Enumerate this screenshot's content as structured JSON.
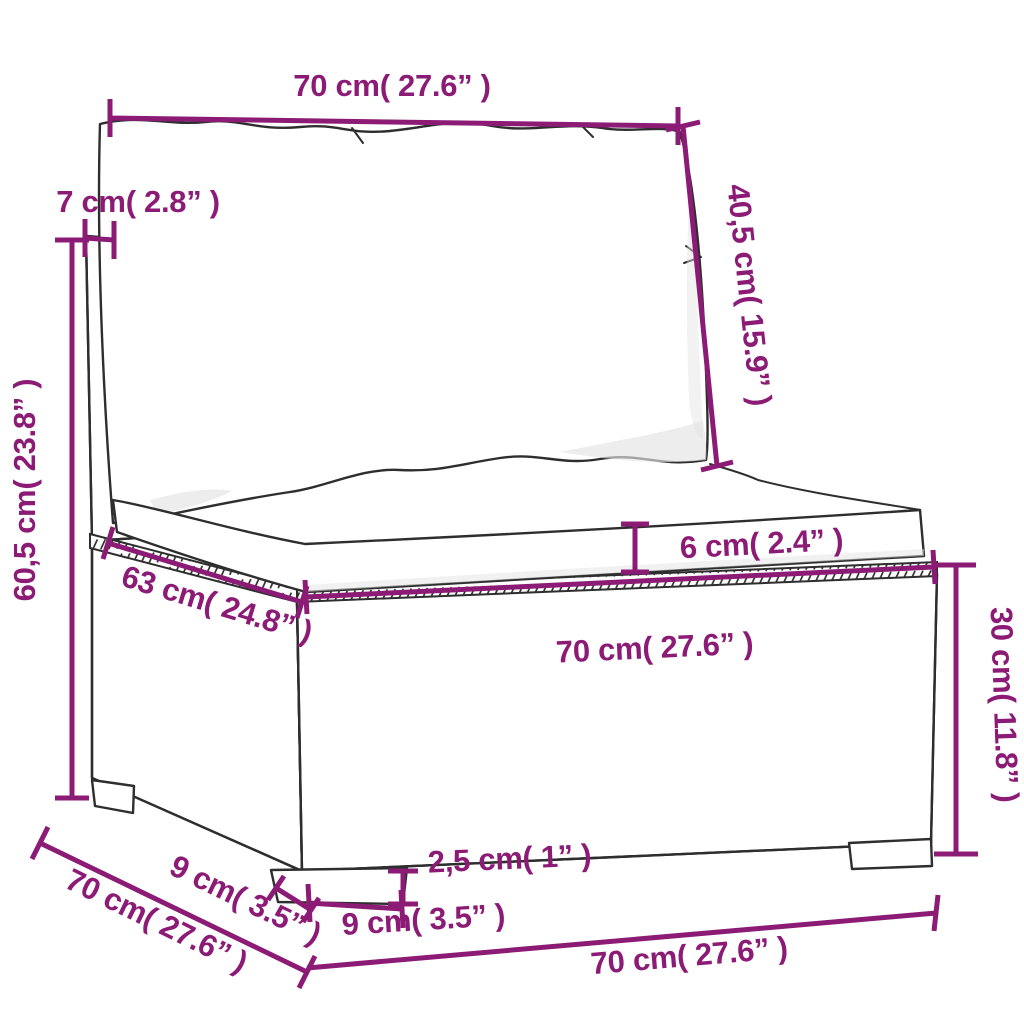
{
  "colors": {
    "dimension_accent": "#8c1b76",
    "line_art": "#2e2e2e"
  },
  "dims": {
    "top_width": "70 cm( 27.6” )",
    "back_cushion_height": "40,5 cm( 15.9” )",
    "back_thickness": "7 cm( 2.8” )",
    "total_height": "60,5 cm( 23.8” )",
    "seat_depth": "63 cm( 24.8” )",
    "cushion_thickness": "6 cm( 2.4” )",
    "seat_width": "70 cm( 27.6” )",
    "base_height": "30 cm( 11.8” )",
    "leg_height": "2,5 cm( 1” )",
    "front_leg_width": "9 cm( 3.5” )",
    "side_leg_depth": "9 cm( 3.5” )",
    "side_depth": "70 cm( 27.6” )",
    "bottom_width": "70 cm( 27.6” )"
  }
}
